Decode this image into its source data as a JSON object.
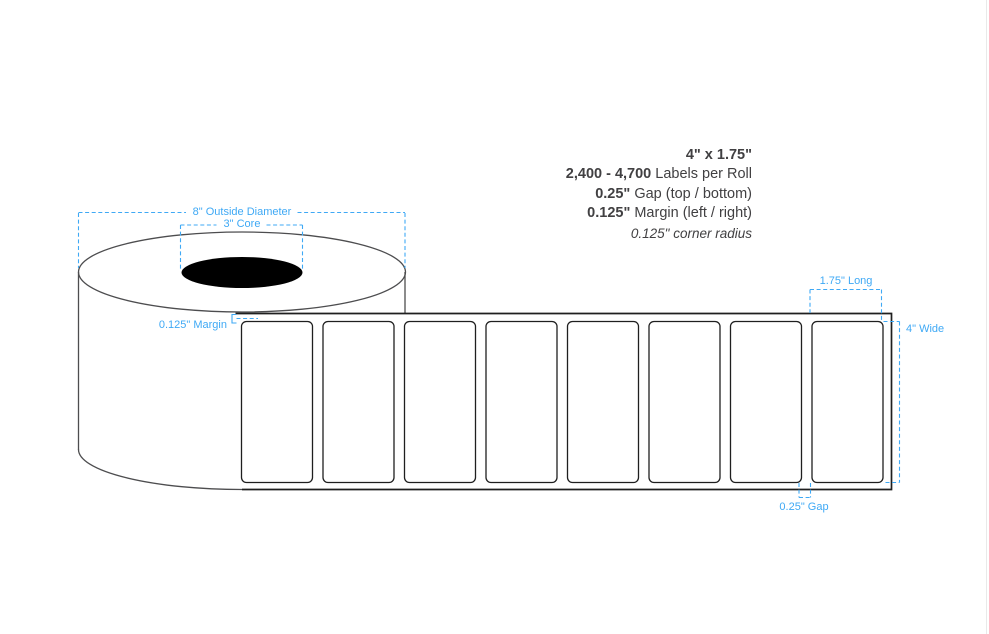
{
  "colors": {
    "annotation_blue": "#3FA9F5",
    "spec_text": "#414042",
    "roll_outline": "#4d4d4f",
    "strip_outline": "#1f1f1f",
    "core_fill": "#000000",
    "page_edge_line": "#e9e9e9"
  },
  "spec_panel": {
    "size": "4\" x 1.75\"",
    "labels_per_roll_value": "2,400 - 4,700",
    "labels_per_roll_label": " Labels per Roll",
    "gap_value": "0.25\"",
    "gap_label": " Gap (top / bottom)",
    "margin_value": "0.125\"",
    "margin_label": " Margin (left / right)",
    "corner_radius": "0.125\" corner radius"
  },
  "diagram": {
    "annotations": {
      "outside_diameter": "8\" Outside Diameter",
      "core": "3\" Core",
      "margin": "0.125\" Margin",
      "length": "1.75\" Long",
      "width": "4\" Wide",
      "gap": "0.25\" Gap"
    },
    "label_count": 8,
    "labels_geometry": {
      "first_x": 241.5,
      "pitch": 81.5,
      "y": 321.5,
      "width": 71,
      "height": 161,
      "corner_radius": 5
    }
  }
}
